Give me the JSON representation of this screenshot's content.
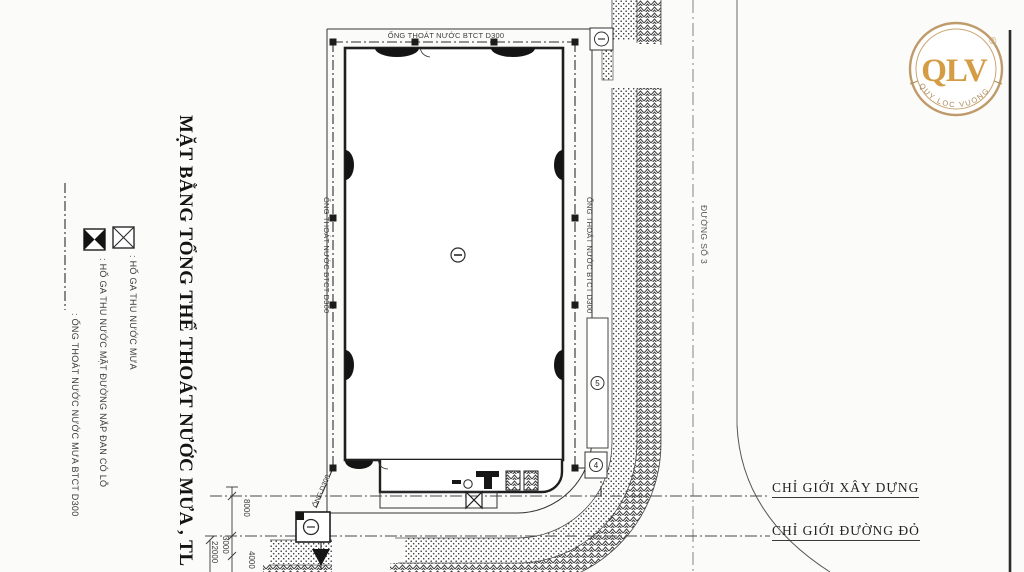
{
  "page": {
    "background": "#fbfbf9"
  },
  "title": {
    "text": "MẶT BẰNG TỔNG THỂ THOÁT NƯỚC MƯA , TL : 1/500"
  },
  "legend": {
    "items": [
      {
        "symbol": "open-box-x-icon",
        "label": ": HỐ GA THU NƯỚC MƯA"
      },
      {
        "symbol": "filled-box-x-icon",
        "label": ": HỐ GA THU NƯỚC MẶT ĐƯỜNG NẮP ĐAN CÓ LỖ"
      },
      {
        "symbol": "dash-dot-line-icon",
        "label": ": ỐNG THOÁT NƯỚC NƯỚC MƯA  BTCT D300"
      }
    ]
  },
  "plan": {
    "pipe_labels": {
      "top": "ỐNG THOÁT NƯỚC BTCT D300",
      "left": "ỐNG THOÁT NƯỚC BTCT D300",
      "right": "ỐNG THOÁT NƯỚC BTCT D300",
      "outlet": "ỐNG D300"
    },
    "road_label": "ĐƯỜNG SỐ 3",
    "boundary_labels": {
      "construction": "CHỈ GIỚI XÂY DỰNG",
      "red_line": "CHỈ GIỚI ĐƯỜNG ĐỎ"
    },
    "markers": {
      "ramp": "5",
      "box": "4"
    },
    "dimensions": [
      "8000",
      "3000",
      "4000",
      "22000"
    ]
  },
  "logo": {
    "monogram": "QLV",
    "registered": "®",
    "ring_text": "QUY LOC VUONG"
  },
  "colors": {
    "line": "#2a2a2a",
    "hatch": "#3c3c3c",
    "gold": "#d49c44",
    "ring": "#bf9a6a"
  }
}
